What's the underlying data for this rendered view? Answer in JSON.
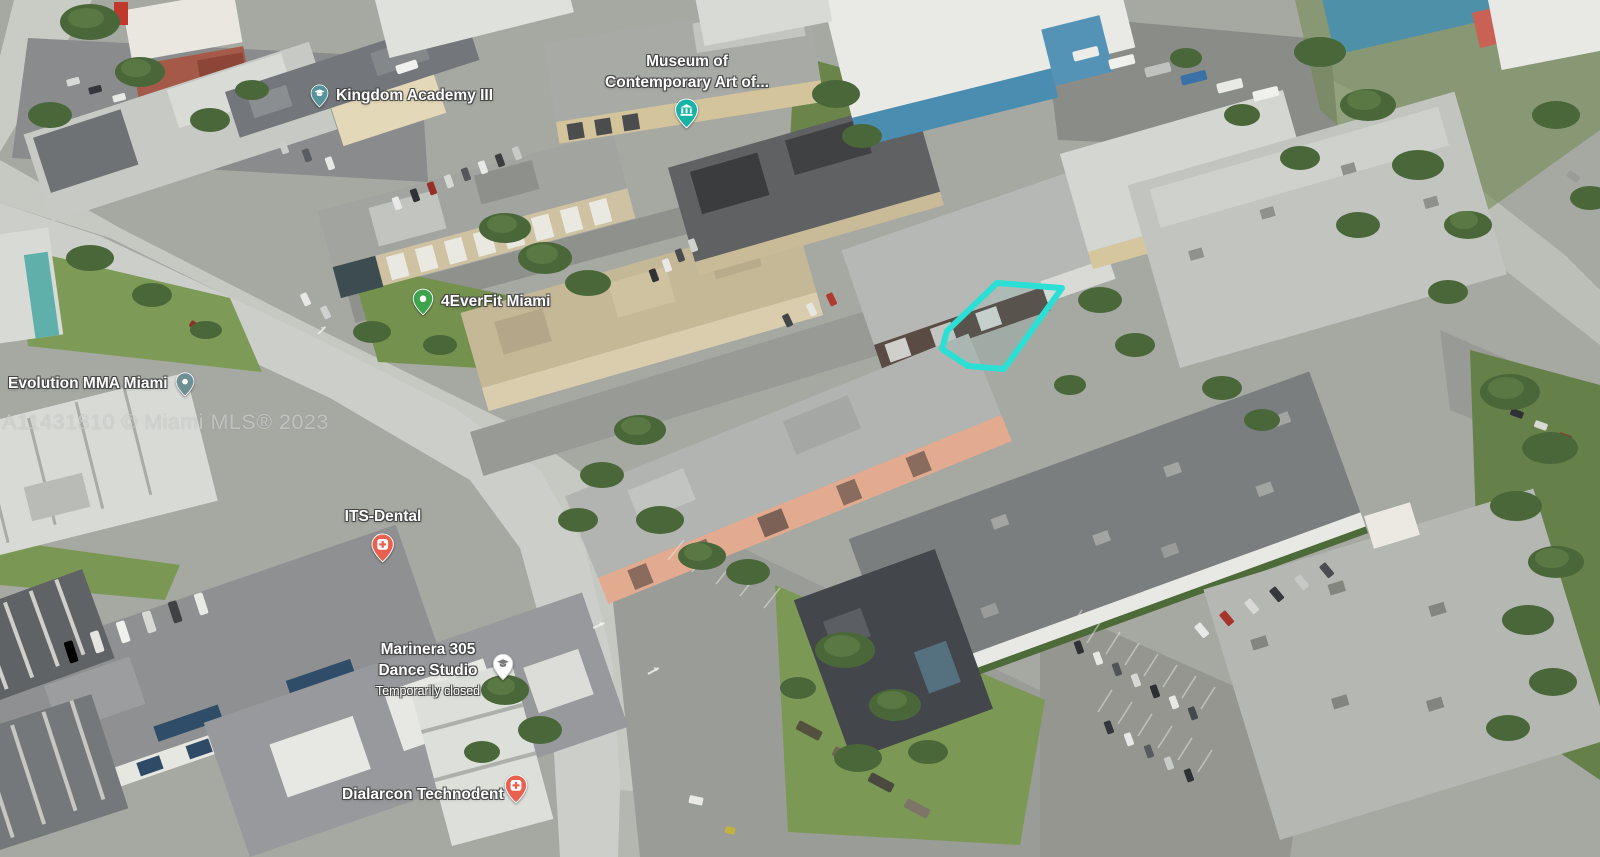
{
  "map": {
    "watermark": "A11431810 © Miami MLS® 2023",
    "highlight": {
      "color": "#2BDFD4",
      "label": "subject-property-outline"
    },
    "pois": [
      {
        "id": "kingdom-academy-iii",
        "label": "Kingdom Academy III",
        "category": "school",
        "pin_color": "#57939B",
        "icon": "graduation-cap"
      },
      {
        "id": "museum-of-contemporary-art",
        "label_line1": "Museum of",
        "label_line2": "Contemporary Art of...",
        "category": "museum",
        "pin_color": "#17B3A6",
        "icon": "museum-building"
      },
      {
        "id": "4everfit-miami",
        "label": "4EverFit Miami",
        "category": "gym",
        "pin_color": "#3DA44D",
        "icon": "dot"
      },
      {
        "id": "evolution-mma-miami",
        "label": "Evolution MMA Miami",
        "category": "gym",
        "pin_color": "#6E8F93",
        "icon": "dot"
      },
      {
        "id": "its-dental",
        "label": "ITS-Dental",
        "category": "dental",
        "pin_color": "#E8604F",
        "icon": "medical-cross"
      },
      {
        "id": "marinera-305-dance-studio",
        "label_line1": "Marinera 305",
        "label_line2": "Dance Studio",
        "status": "Temporarily closed",
        "category": "dance-school",
        "pin_color": "#FFFFFF",
        "icon": "graduation-cap-gray",
        "icon_color": "#7B7B7B"
      },
      {
        "id": "dialarcon-technodent",
        "label": "Dialarcon Technodent",
        "category": "dental",
        "pin_color": "#E8604F",
        "icon": "medical-cross"
      }
    ]
  }
}
